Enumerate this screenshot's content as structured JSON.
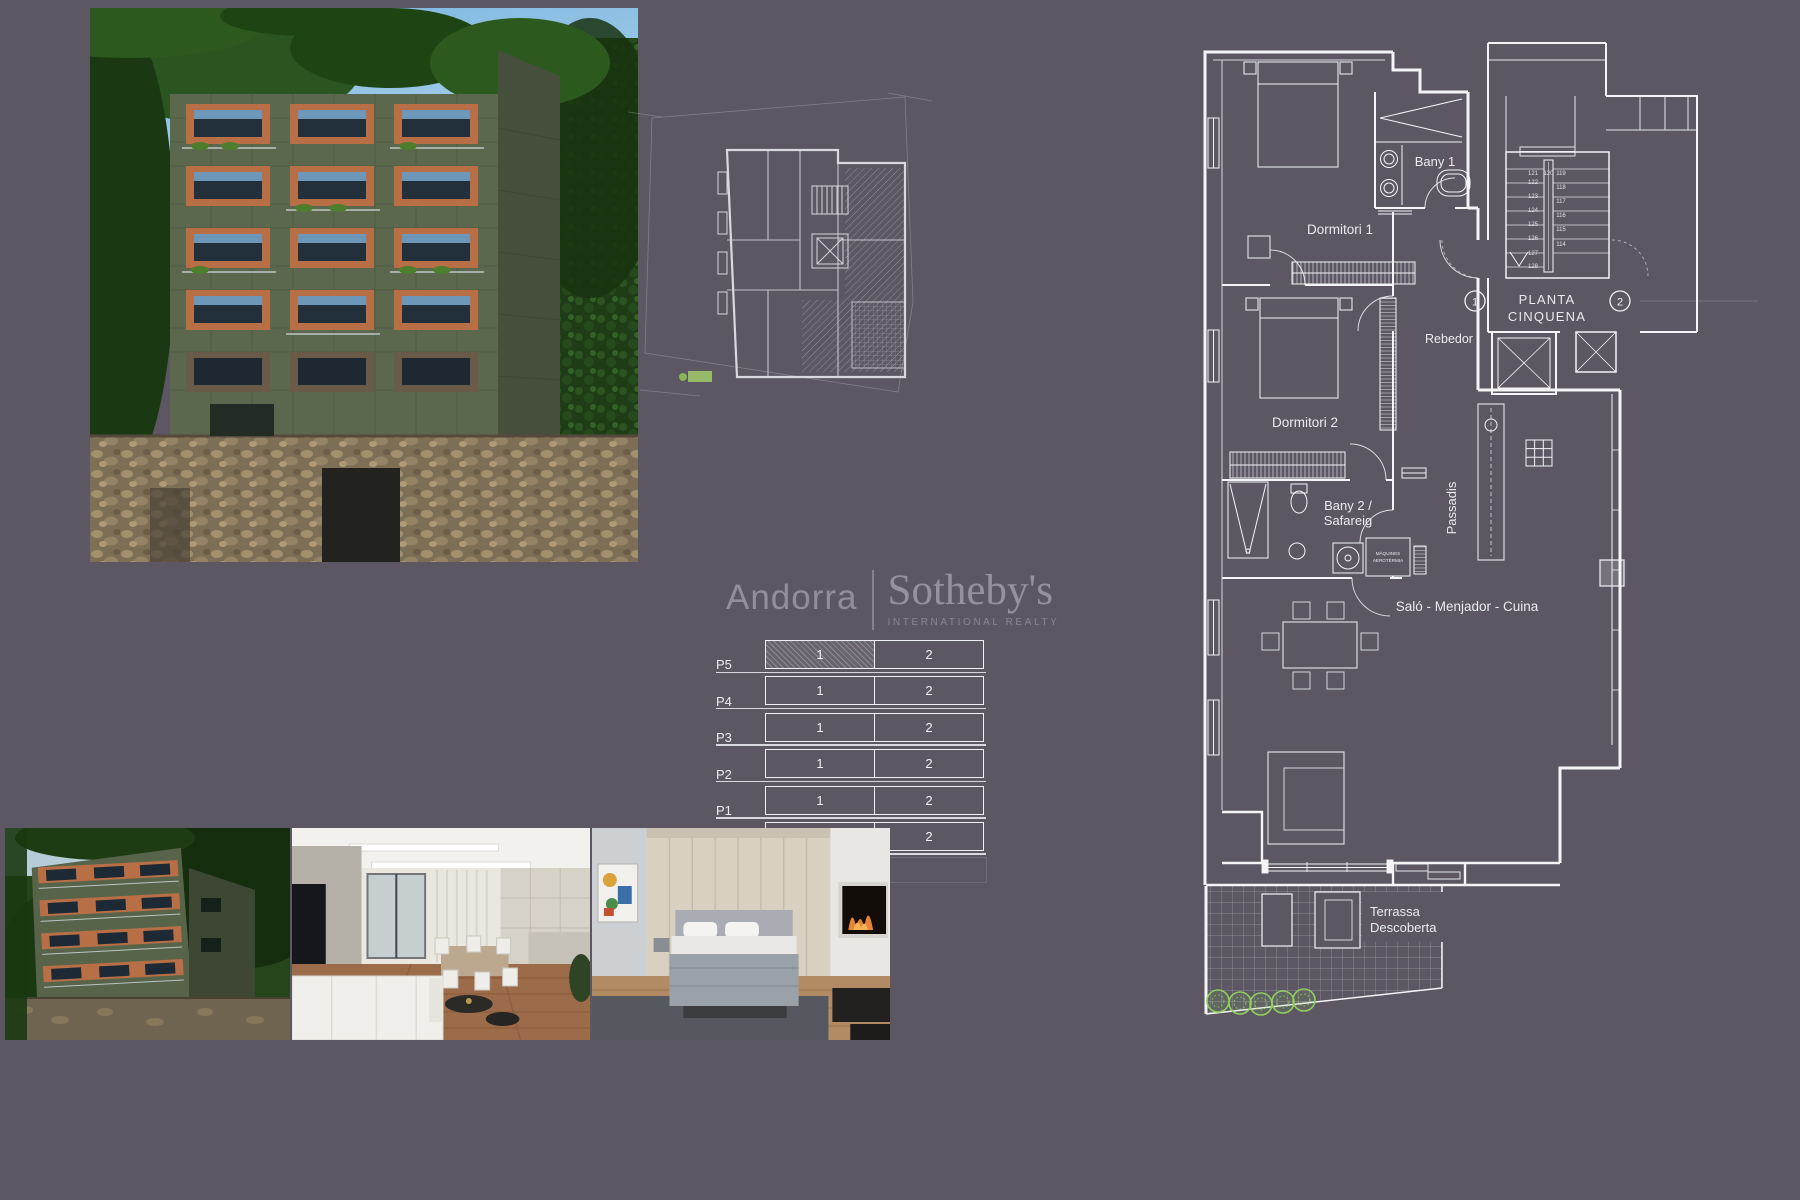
{
  "colors": {
    "background": "#5c5763",
    "plan_line": "#f4f4f7",
    "accent_green": "#8ecf5e",
    "logo_text": "#96919f"
  },
  "logo": {
    "brand": "Andorra",
    "name": "Sotheby's",
    "subtitle": "INTERNATIONAL REALTY"
  },
  "floorplan": {
    "title_line1": "PLANTA",
    "title_line2": "CINQUENA",
    "axis_markers": [
      "1",
      "2"
    ],
    "rooms": {
      "bany1": "Bany 1",
      "dormitori1": "Dormitori 1",
      "rebedor": "Rebedor",
      "dormitori2": "Dormitori 2",
      "bany2": "Bany 2 /",
      "safareig": "Safareig",
      "passadis": "Passadis",
      "salo": "Saló - Menjador - Cuina",
      "terrassa1": "Terrassa",
      "terrassa2": "Descoberta",
      "maquines1": "MÀQUINES",
      "maquines2": "AEROTÈRMIA"
    },
    "stair_steps": {
      "left": [
        "121",
        "122",
        "123",
        "124",
        "125",
        "126",
        "127",
        "128"
      ],
      "middle": "120",
      "right": [
        "119",
        "118",
        "117",
        "116",
        "115",
        "114"
      ]
    }
  },
  "units_table": {
    "rows": [
      {
        "label": "P5",
        "cells": [
          "1",
          "2"
        ],
        "highlighted_cell": 0
      },
      {
        "label": "P4",
        "cells": [
          "1",
          "2"
        ]
      },
      {
        "label": "P3",
        "cells": [
          "1",
          "2"
        ]
      },
      {
        "label": "P2",
        "cells": [
          "1",
          "2"
        ]
      },
      {
        "label": "P1",
        "cells": [
          "1",
          "2"
        ]
      },
      {
        "label": "PB",
        "cells": [
          "1",
          "2"
        ]
      }
    ]
  }
}
